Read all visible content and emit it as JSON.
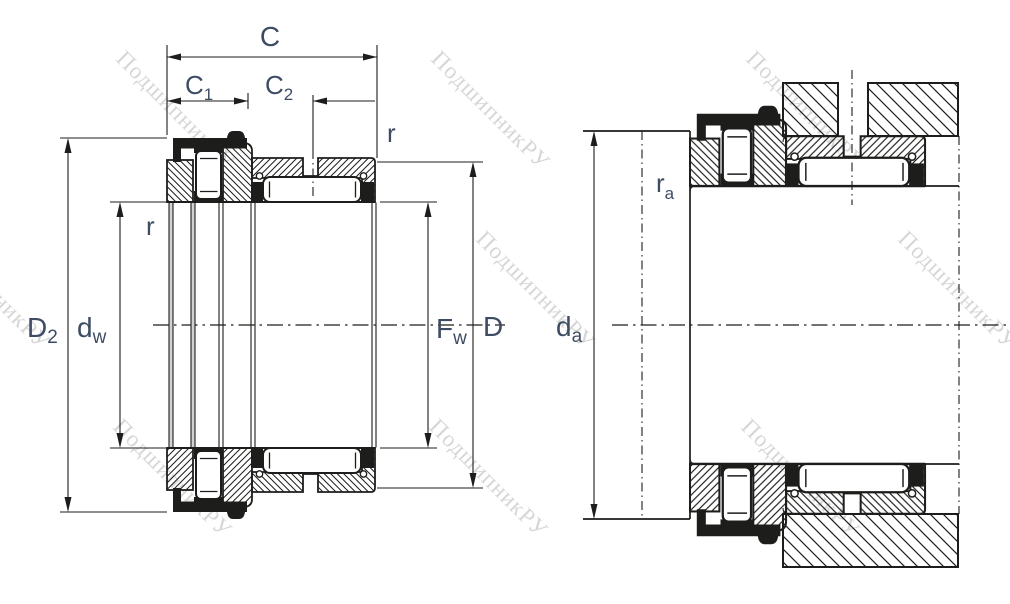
{
  "drawing": {
    "watermark": {
      "text": "ПодшипникРУ"
    },
    "colors": {
      "line": "#1d1d1b",
      "label": "#3e4c63",
      "watermark": "#d6d6d6",
      "bore_gap_gray": "#d2d2d2"
    },
    "left_view": {
      "labels": {
        "C": "C",
        "C1": {
          "base": "C",
          "sub": "1"
        },
        "C2": {
          "base": "C",
          "sub": "2"
        },
        "r_top": "r",
        "r_left": "r",
        "D2": {
          "base": "D",
          "sub": "2"
        },
        "dw": {
          "base": "d",
          "sub": "w"
        },
        "Fw": {
          "base": "F",
          "sub": "w"
        },
        "D": "D"
      }
    },
    "right_view": {
      "labels": {
        "da": {
          "base": "d",
          "sub": "a"
        },
        "ra": {
          "base": "r",
          "sub": "a"
        }
      }
    }
  }
}
